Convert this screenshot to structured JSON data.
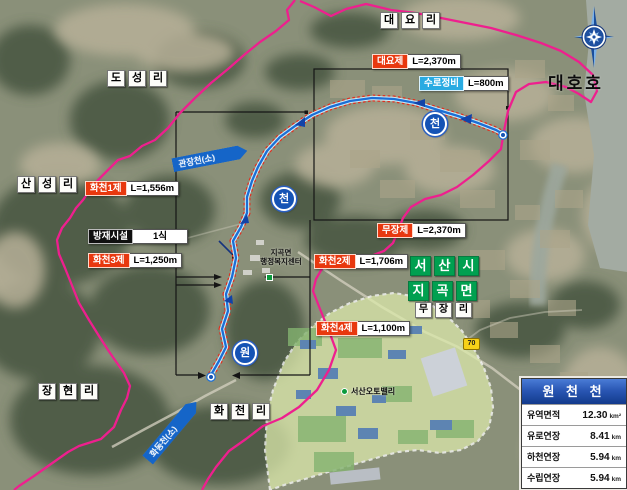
{
  "colors": {
    "watershed_boundary": "#ee1f8e",
    "stream_line": "#1b6fd6",
    "stream_dash": "#e03020",
    "label_red": "#e8380f",
    "label_blue": "#29abe2",
    "green_box": "#00a050",
    "table_header_blue": "#1b4fa5",
    "industrial_area_fill": "#dce9ab",
    "route_badge_yellow": "#f7d118"
  },
  "compass": {
    "name": "compass-rose"
  },
  "lake": {
    "label": "대호호"
  },
  "place_names": [
    {
      "id": "daeyo-ri",
      "text": "대요리",
      "style": "white",
      "x": 380,
      "y": 12
    },
    {
      "id": "doseong-ri",
      "text": "도성리",
      "style": "white",
      "x": 107,
      "y": 70
    },
    {
      "id": "sanseong-ri",
      "text": "산성리",
      "style": "white",
      "x": 17,
      "y": 176
    },
    {
      "id": "janghyeon-ri",
      "text": "장현리",
      "style": "white",
      "x": 38,
      "y": 383
    },
    {
      "id": "hwacheon-ri",
      "text": "화천리",
      "style": "white",
      "x": 210,
      "y": 403
    },
    {
      "id": "seosan-si",
      "text": "서산시",
      "style": "green",
      "x": 410,
      "y": 256
    },
    {
      "id": "jigok-myeon",
      "text": "지곡면",
      "style": "green",
      "x": 408,
      "y": 281
    },
    {
      "id": "mujang-ri",
      "text": "무장리",
      "style": "white-sm",
      "x": 415,
      "y": 302
    }
  ],
  "measurements": [
    {
      "id": "daeyo-je",
      "name": "대요제",
      "value": "L=2,370m",
      "color": "red",
      "x": 372,
      "y": 54
    },
    {
      "id": "suro-jeongbi",
      "name": "수로정비",
      "value": "L=800m",
      "color": "blue",
      "x": 419,
      "y": 76
    },
    {
      "id": "hwacheon-1",
      "name": "화천1제",
      "value": "L=1,556m",
      "color": "red",
      "x": 85,
      "y": 181
    },
    {
      "id": "mujang-je",
      "name": "무장제",
      "value": "L=2,370m",
      "color": "red",
      "x": 377,
      "y": 223
    },
    {
      "id": "hwacheon-2",
      "name": "화천2제",
      "value": "L=1,706m",
      "color": "red",
      "x": 314,
      "y": 254
    },
    {
      "id": "hwacheon-3",
      "name": "화천3제",
      "value": "L=1,250m",
      "color": "red",
      "x": 88,
      "y": 253
    },
    {
      "id": "hwacheon-4",
      "name": "화천4제",
      "value": "L=1,100m",
      "color": "red",
      "x": 316,
      "y": 321
    },
    {
      "id": "bangjae-sisol",
      "name": "방재시설",
      "value": "1식",
      "color": "black",
      "x": 88,
      "y": 229,
      "value_w": 46,
      "center": true
    }
  ],
  "stream_badges": [
    {
      "id": "cheon-mid",
      "text": "천",
      "x": 272,
      "y": 187
    },
    {
      "id": "cheon-east",
      "text": "천",
      "x": 423,
      "y": 112
    },
    {
      "id": "won-south",
      "text": "원",
      "x": 233,
      "y": 341
    }
  ],
  "stream_banners": [
    {
      "id": "gwanjang-cheon",
      "text": "관장천(소)",
      "x": 172,
      "y": 151,
      "angle": -11,
      "w": 58
    },
    {
      "id": "hwadong-cheon",
      "text": "화동천(소)",
      "x": 134,
      "y": 424,
      "angle": -50,
      "w": 58
    }
  ],
  "admin_center": {
    "line1": "지곡면",
    "line2": "행정복지센터"
  },
  "auto_valley": {
    "label": "서산오토밸리"
  },
  "route_badge": {
    "number": "70"
  },
  "info_table": {
    "title": "원 천 천",
    "rows": [
      {
        "label": "유역면적",
        "value": "12.30",
        "unit": "km²"
      },
      {
        "label": "유로연장",
        "value": "8.41",
        "unit": "km"
      },
      {
        "label": "하천연장",
        "value": "5.94",
        "unit": "km"
      },
      {
        "label": "수립연장",
        "value": "5.94",
        "unit": "km"
      }
    ]
  }
}
